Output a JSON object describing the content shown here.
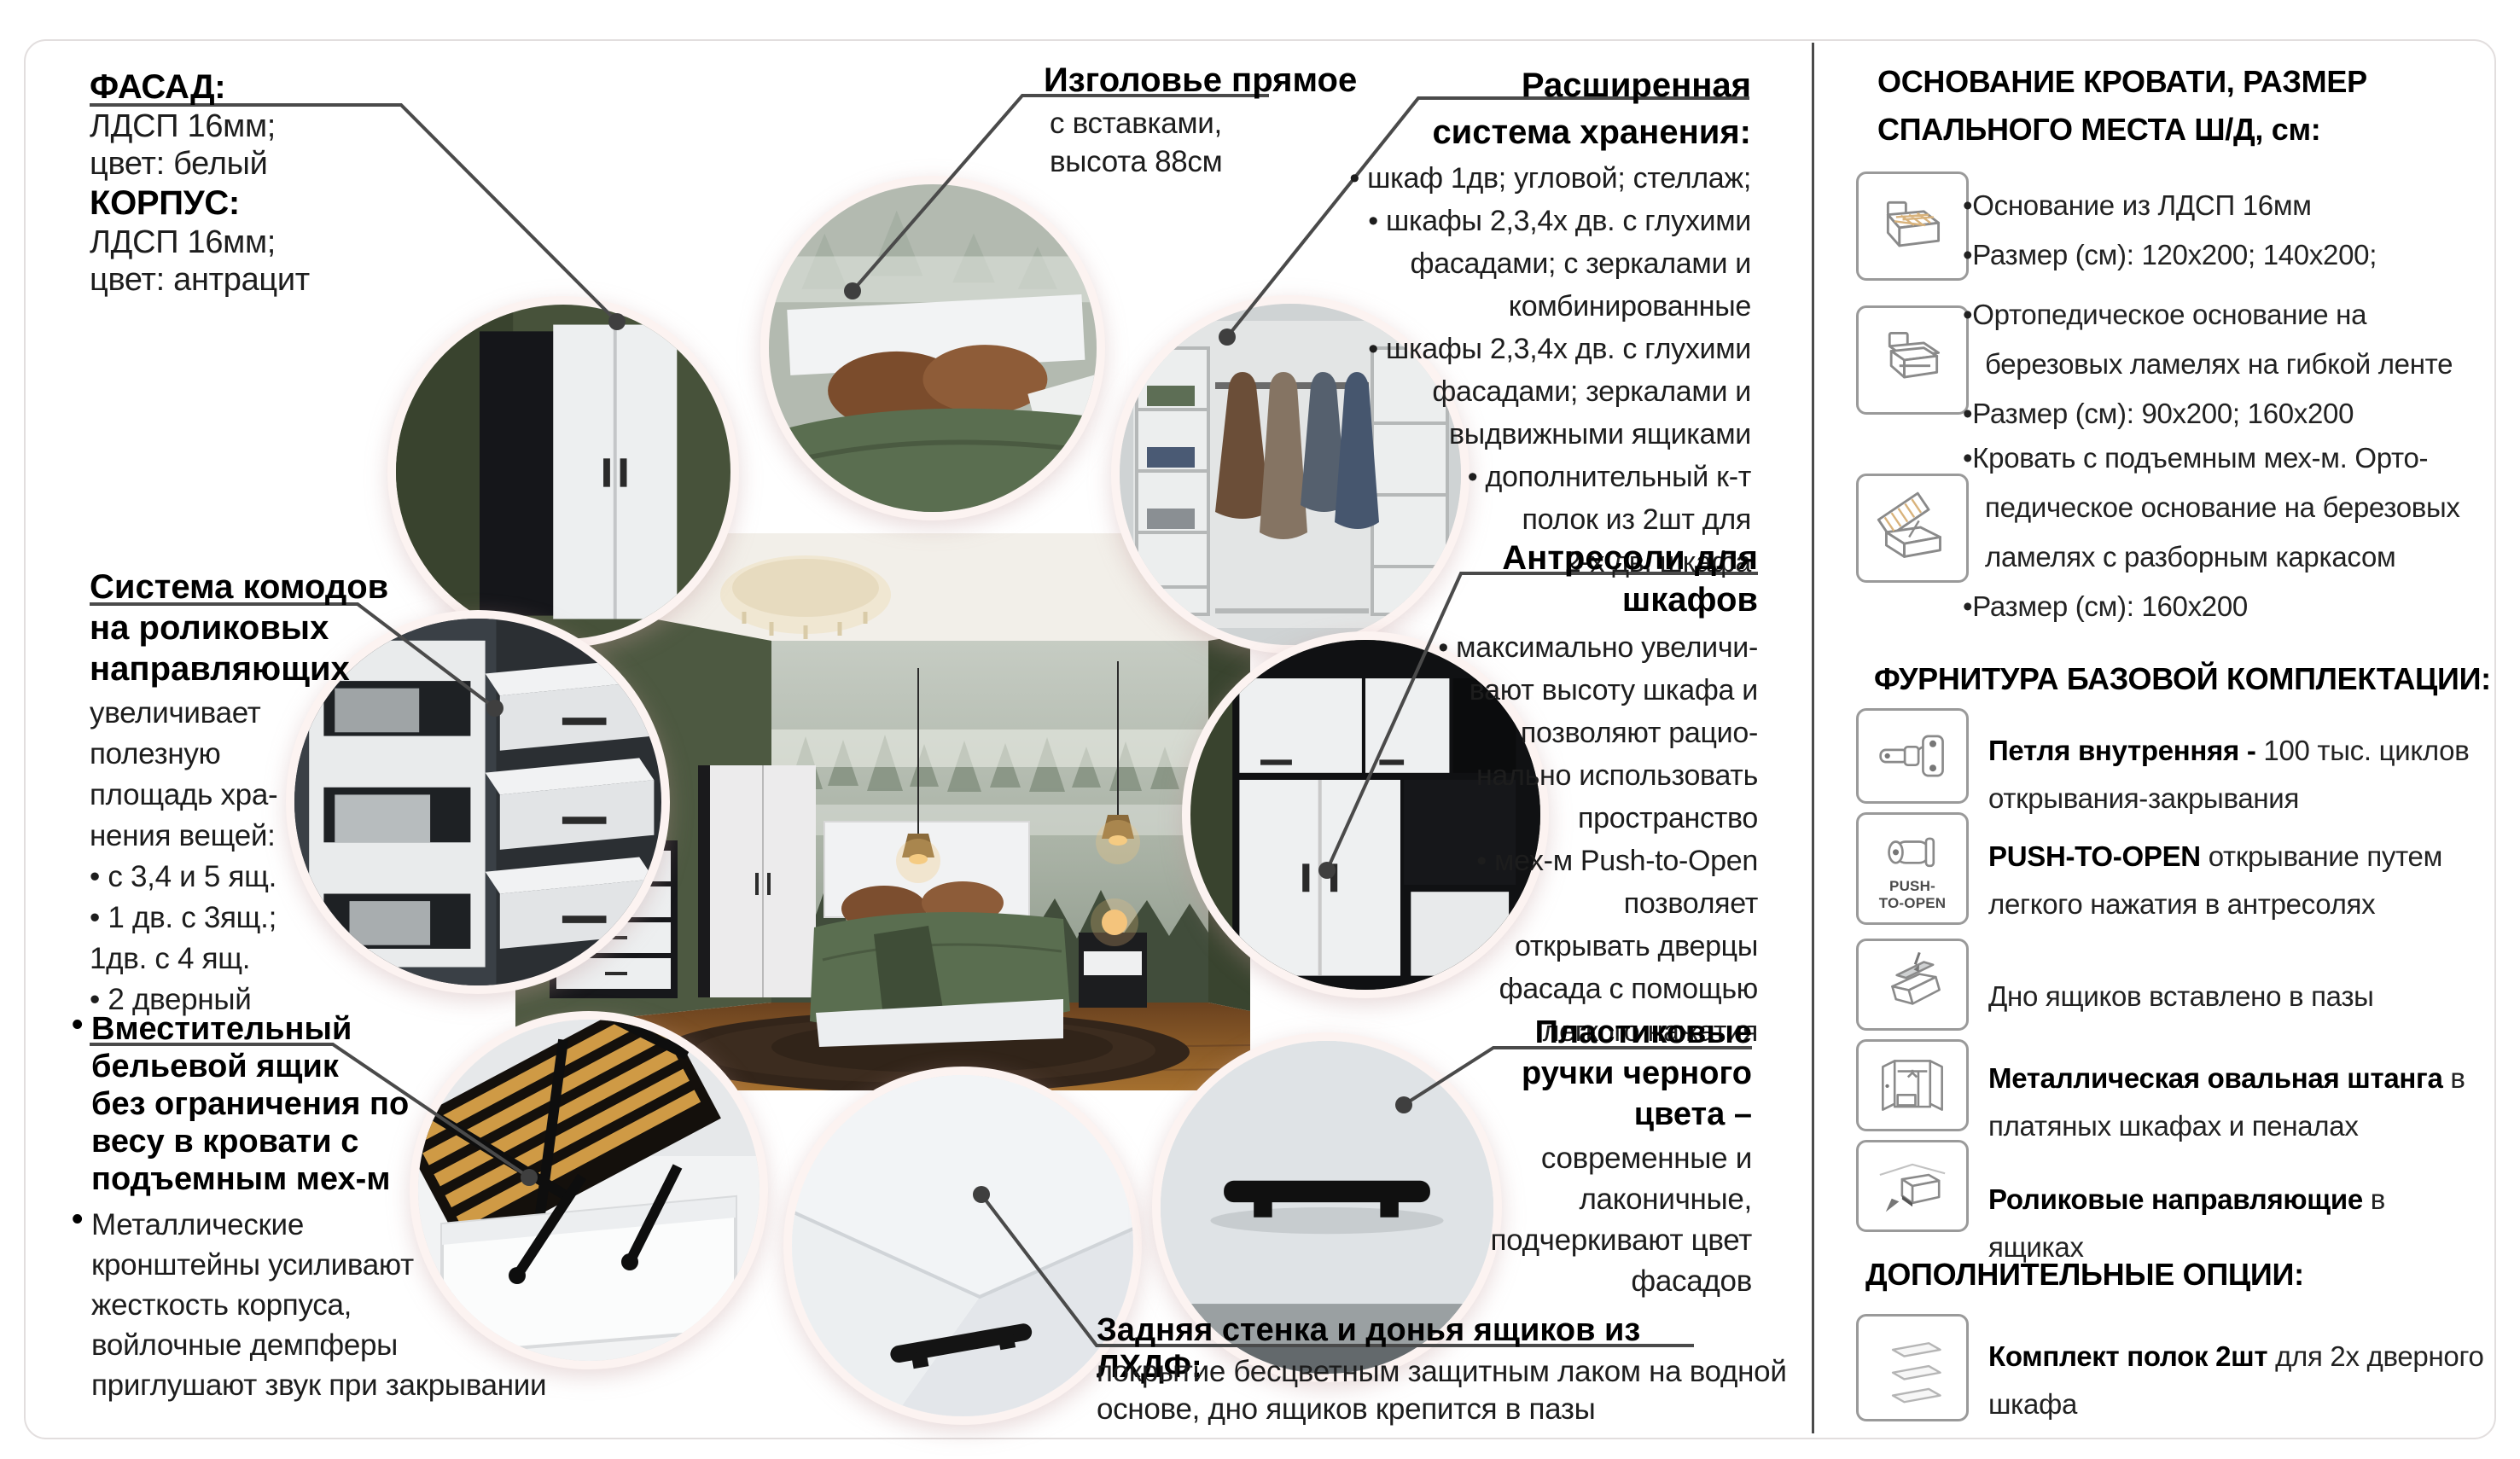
{
  "callouts": {
    "facade": {
      "title1": "ФАСАД:",
      "line1": "ЛДСП 16мм;",
      "line2": "цвет: белый",
      "title2": "КОРПУС:",
      "line3": "ЛДСП 16мм;",
      "line4": "цвет: антрацит"
    },
    "headboard": {
      "title": "Изголовье прямое",
      "lines": [
        "с вставками,",
        "высота 88см"
      ]
    },
    "storage": {
      "title_line1": "Расширенная",
      "title_line2": "система хранения:",
      "lines": [
        "• шкаф 1дв; угловой; стеллаж;",
        "• шкафы 2,3,4х дв. с глухими",
        "фасадами; с зеркалами и",
        "комбинированные",
        "• шкафы 2,3,4х дв. с глухими",
        "фасадами; зеркалами и",
        "выдвижными ящиками",
        "• дополнительный к-т",
        "полок из 2шт для",
        "2-х дв. шкафа"
      ]
    },
    "antresol": {
      "title_line1": "Антресоли для",
      "title_line2": "шкафов",
      "lines": [
        "• максимально увеличи-",
        "вают высоту шкафа и",
        "позволяют рацио-",
        "нально использовать",
        "пространство",
        "• мех-м Push-to-Open",
        "позволяет",
        "открывать дверцы",
        "фасада с помощью",
        "легкого нажатия"
      ]
    },
    "commodes": {
      "title_lines": [
        "Система комодов",
        "на роликовых",
        "направляющих"
      ],
      "lines": [
        "увеличивает",
        "полезную",
        "площадь хра-",
        "нения вещей:",
        "• с 3,4 и 5 ящ.",
        "• 1 дв. с 3ящ.;",
        "1дв. с 4 ящ.",
        "• 2 дверный"
      ]
    },
    "bed_drawer": {
      "bullet": "•",
      "title_lines": [
        "Вместительный",
        "бельевой ящик",
        "без ограничения по",
        "весу в кровати с",
        "подъемным мех-м"
      ],
      "body_lines": [
        "Металлические",
        "кронштейны усиливают",
        "жесткость корпуса,",
        "войлочные демпферы",
        "приглушают звук при закрывании"
      ]
    },
    "handles": {
      "title_lines": [
        "Пластиковые",
        "ручки черного",
        "цвета –"
      ],
      "lines": [
        "современные и",
        "лаконичные,",
        "подчеркивают цвет",
        "фасадов"
      ]
    },
    "back_panel": {
      "title": "Задняя стенка и донья ящиков из ЛХДФ:",
      "lines": [
        "покрытие бесцветным защитным лаком на водной",
        "основе, дно ящиков крепится в пазы"
      ]
    }
  },
  "sidebar": {
    "base_title_lines": [
      "ОСНОВАНИЕ КРОВАТИ, РАЗМЕР",
      "СПАЛЬНОГО МЕСТА Ш/Д, см:"
    ],
    "base_items": [
      {
        "icon": "bed-base-icon",
        "lines": [
          "•Основание из ЛДСП 16мм",
          "•Размер (см): 120х200; 140х200;"
        ]
      },
      {
        "icon": "bed-ortho-icon",
        "lines": [
          "•Ортопедическое основание на",
          "березовых ламелях на гибкой ленте",
          "•Размер (см): 90х200; 160х200"
        ]
      },
      {
        "icon": "bed-lift-icon",
        "lines": [
          "•Кровать с подъемным мех-м. Орто-",
          "педическое основание на березовых",
          "ламелях с разборным каркасом",
          "•Размер (см): 160х200"
        ]
      }
    ],
    "fittings_title": "ФУРНИТУРА БАЗОВОЙ КОМПЛЕКТАЦИИ:",
    "fittings": [
      {
        "icon": "hinge-icon",
        "bold": "Петля внутренняя - ",
        "rest": "100 тыс. циклов открывания-закрывания"
      },
      {
        "icon": "push-to-open-icon",
        "icon_label_lines": [
          "PUSH-",
          "TO-OPEN"
        ],
        "bold": "PUSH-TO-OPEN ",
        "rest": "открывание путем легкого нажатия в антресолях"
      },
      {
        "icon": "drawer-bottom-icon",
        "bold": "",
        "rest": "Дно ящиков вставлено в пазы"
      },
      {
        "icon": "oval-rod-icon",
        "bold": "Металлическая овальная штанга",
        "rest": " в платяных шкафах и пеналах"
      },
      {
        "icon": "roller-guides-icon",
        "bold": "Роликовые направляющие",
        "rest": " в ящиках"
      }
    ],
    "options_title": "ДОПОЛНИТЕЛЬНЫЕ ОПЦИИ:",
    "options": [
      {
        "icon": "shelves-kit-icon",
        "bold": "Комплект полок 2шт",
        "rest": " для 2х дверного шкафа"
      }
    ]
  },
  "colors": {
    "connector": "#4a4a4a",
    "divider": "#4a4a4a",
    "circle_ring": "#fcf3f1",
    "wall_green": "#4d5941",
    "bedding_green": "#5a6e50",
    "wood_floor": "#8a5a33",
    "handle_black": "#111111"
  }
}
